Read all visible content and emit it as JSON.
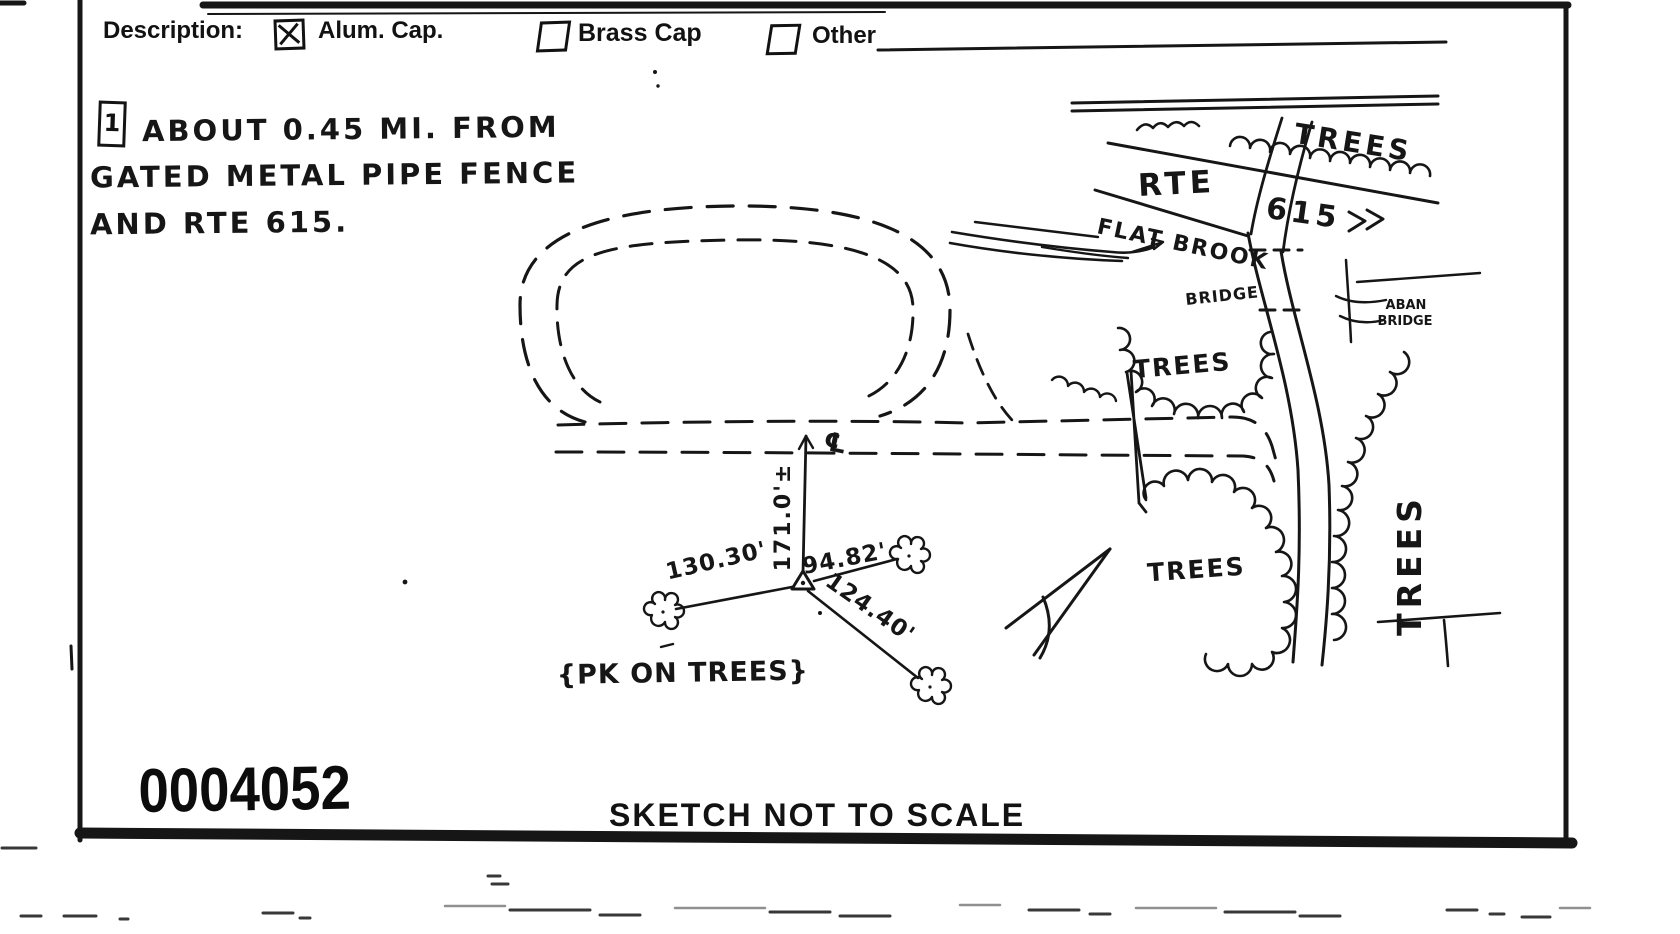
{
  "header": {
    "description_label": "Description:",
    "options": [
      {
        "label": "Alum. Cap.",
        "checked": true
      },
      {
        "label": "Brass Cap",
        "checked": false
      },
      {
        "label": "Other",
        "checked": false
      }
    ]
  },
  "note": {
    "marker": "1",
    "lines": [
      "ABOUT 0.45 MI. FROM",
      "GATED METAL PIPE FENCE",
      "AND RTE 615."
    ]
  },
  "sketch": {
    "labels": {
      "trees_top": "TREES",
      "route": "RTE",
      "route_number": "615",
      "flat_brook": "FLAT BROOK",
      "bridge": "BRIDGE",
      "aban_line1": "ABAN",
      "aban_line2": "BRIDGE",
      "trees_mid": "TREES",
      "trees_lower": "TREES",
      "trees_right": "TREES",
      "centerline_symbol": "℄",
      "dist_centerline": "171.0'±",
      "dist_left": "130.30'",
      "dist_right": "94.82'",
      "dist_diagonal": "124.40'",
      "pk_note": "{PK ON TREES}"
    }
  },
  "footer": {
    "stamp_number": "0004052",
    "scale_note": "SKETCH NOT TO SCALE"
  }
}
